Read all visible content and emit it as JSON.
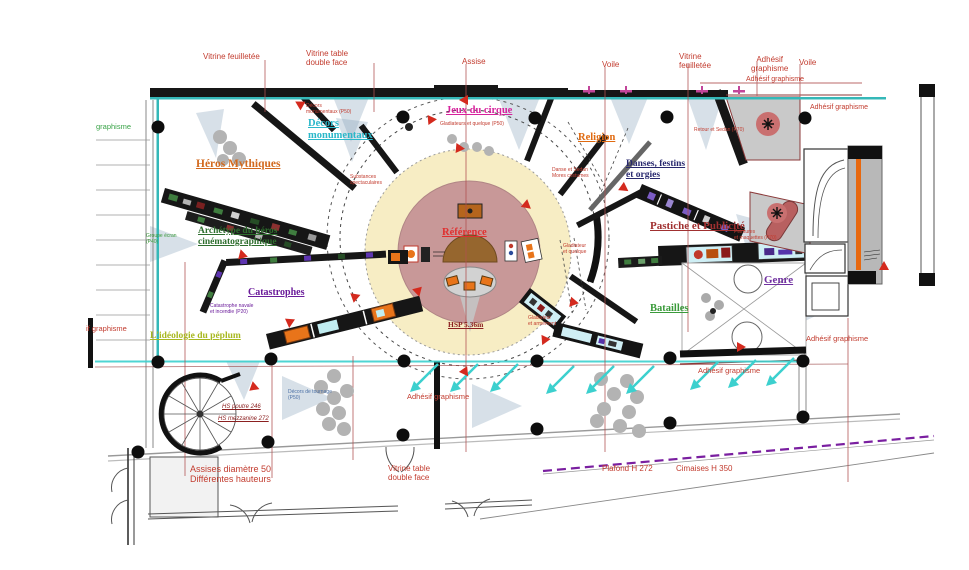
{
  "canvas": {
    "width": 969,
    "height": 570
  },
  "document_type": "exhibition-floor-plan",
  "colors": {
    "wall_black": "#161616",
    "teal_line": "#35b8b8",
    "callout_red": "#c23b2e",
    "dim_line_red": "#b05050",
    "cream_circle": "#f7edc4",
    "mauve_circle": "#c89898",
    "dome_brown": "#96662e",
    "vitrine_orange": "#e8741a",
    "display_cyan": "#cfeff5",
    "room_gray": "#c9c9c9",
    "rose_circle": "#c97070",
    "capsule_rose": "#b86060",
    "arrow_cyan": "#3cd0ce",
    "purple_dashed": "#7a1fa0",
    "stool_gray": "#b3b3b3"
  },
  "labels": [
    {
      "id": "vitrine-feuilletee-top",
      "text": "Vitrine feuilletée",
      "x": 203,
      "y": 52,
      "size": 8,
      "color": "#c23b2e"
    },
    {
      "id": "vitrine-table-top",
      "text": "Vitrine table\ndouble face",
      "x": 306,
      "y": 49,
      "size": 8,
      "color": "#c23b2e"
    },
    {
      "id": "assise-top",
      "text": "Assise",
      "x": 462,
      "y": 57,
      "size": 8,
      "color": "#c23b2e"
    },
    {
      "id": "voile-top-1",
      "text": "Voile",
      "x": 602,
      "y": 60,
      "size": 8,
      "color": "#c23b2e"
    },
    {
      "id": "vitrine-feuilletee-top-2",
      "text": "Vitrine\nfeuilletée",
      "x": 679,
      "y": 52,
      "size": 8,
      "color": "#c23b2e"
    },
    {
      "id": "adhesif-graphisme-top",
      "text": "Adhésif\ngraphisme",
      "x": 751,
      "y": 55,
      "size": 8,
      "color": "#c23b2e",
      "align": "center"
    },
    {
      "id": "voile-top-2",
      "text": "Voile",
      "x": 799,
      "y": 58,
      "size": 8,
      "color": "#c23b2e"
    },
    {
      "id": "adhesif-graphisme-line",
      "text": "Adhésif graphisme",
      "x": 746,
      "y": 76,
      "size": 7,
      "color": "#c23b2e"
    },
    {
      "id": "adhesif-graphisme-right-top",
      "text": "Adhésif graphisme",
      "x": 810,
      "y": 104,
      "size": 7,
      "color": "#c23b2e"
    },
    {
      "id": "graphisme-left",
      "text": "graphisme",
      "x": 96,
      "y": 123,
      "size": 7.5,
      "color": "#3aa348"
    },
    {
      "id": "if-graphisme-left",
      "text": "if graphisme",
      "x": 86,
      "y": 325,
      "size": 7.5,
      "color": "#c23b2e"
    },
    {
      "id": "heros-mythiques",
      "text": "Héros Mythiques",
      "x": 196,
      "y": 158,
      "size": 11.5,
      "color": "#d2691e",
      "bold": true,
      "underline": true,
      "serif": true
    },
    {
      "id": "decors-monumentaux",
      "text": "Décors\nmonumentaux",
      "x": 308,
      "y": 118,
      "size": 10.5,
      "color": "#2ab7c9",
      "bold": true,
      "underline": true,
      "serif": true
    },
    {
      "id": "jeux-du-cirque",
      "text": "Jeux du cirque",
      "x": 446,
      "y": 105,
      "size": 10.5,
      "color": "#d6219c",
      "bold": true,
      "underline": true,
      "serif": true
    },
    {
      "id": "religion",
      "text": "Religion",
      "x": 578,
      "y": 132,
      "size": 10.5,
      "color": "#e06a10",
      "bold": true,
      "underline": true,
      "serif": true
    },
    {
      "id": "danses-festins-et-orgies",
      "text": "Danses, festins\net orgies",
      "x": 626,
      "y": 159,
      "size": 9.5,
      "color": "#28286e",
      "bold": true,
      "underline": true,
      "serif": true
    },
    {
      "id": "pastiche-et-publicite",
      "text": "Pastiche et Publicité",
      "x": 650,
      "y": 220,
      "size": 11,
      "color": "#a03030",
      "bold": true,
      "underline": true,
      "serif": true
    },
    {
      "id": "genre",
      "text": "Genre",
      "x": 764,
      "y": 274,
      "size": 11,
      "color": "#7030a0",
      "bold": true,
      "underline": true,
      "serif": true
    },
    {
      "id": "batailles",
      "text": "Batailles",
      "x": 650,
      "y": 303,
      "size": 10.5,
      "color": "#3a9a3a",
      "bold": true,
      "underline": true,
      "serif": true
    },
    {
      "id": "archetype-du-heros",
      "text": "Archétype du héros\ncinématographique",
      "x": 198,
      "y": 226,
      "size": 9.5,
      "color": "#2e6e2e",
      "bold": true,
      "underline": true,
      "serif": true
    },
    {
      "id": "catastrophes",
      "text": "Catastrophes",
      "x": 248,
      "y": 287,
      "size": 10,
      "color": "#6a1b9a",
      "bold": true,
      "underline": true,
      "serif": true
    },
    {
      "id": "ideologie-du-peplum",
      "text": "L'idéologie du péplum",
      "x": 150,
      "y": 331,
      "size": 9.5,
      "color": "#a8b820",
      "bold": true,
      "underline": true,
      "serif": true
    },
    {
      "id": "reference",
      "text": "Référence",
      "x": 442,
      "y": 227,
      "size": 10.5,
      "color": "#e03030",
      "bold": true,
      "underline": true,
      "serif": true
    },
    {
      "id": "adhesif-graphisme-bottom-center",
      "text": "Adhésif graphisme",
      "x": 407,
      "y": 393,
      "size": 7.5,
      "color": "#c23b2e"
    },
    {
      "id": "adhesif-graphisme-bottom-right",
      "text": "Adhésif graphisme",
      "x": 698,
      "y": 367,
      "size": 7.5,
      "color": "#c23b2e"
    },
    {
      "id": "adhesif-graphisme-right-mid",
      "text": "Adhésif graphisme",
      "x": 806,
      "y": 335,
      "size": 7.5,
      "color": "#c23b2e"
    },
    {
      "id": "assises-diametre",
      "text": "Assises diamètre 50\nDifférentes hauteurs",
      "x": 190,
      "y": 464,
      "size": 9,
      "color": "#c23b2e"
    },
    {
      "id": "vitrine-table-bottom",
      "text": "Vitrine table\ndouble face",
      "x": 388,
      "y": 464,
      "size": 8,
      "color": "#c23b2e"
    },
    {
      "id": "plafond-h272",
      "text": "Plafond H 272",
      "x": 602,
      "y": 464,
      "size": 8,
      "color": "#c23b2e"
    },
    {
      "id": "cimaises-h350",
      "text": "Cimaises  H 350",
      "x": 676,
      "y": 464,
      "size": 8,
      "color": "#c23b2e"
    },
    {
      "id": "hsp-536",
      "text": "HSP 5.36m",
      "x": 448,
      "y": 321,
      "size": 7.5,
      "color": "#8b2020",
      "bold": true,
      "underline": true,
      "serif": true
    },
    {
      "id": "hs-poutre",
      "text": "HS poutre 246",
      "x": 222,
      "y": 404,
      "size": 6,
      "color": "#8b2020",
      "italic": true,
      "underline": true
    },
    {
      "id": "hs-mezzanine",
      "text": "HS mezzanine 272",
      "x": 218,
      "y": 416,
      "size": 6,
      "color": "#8b2020",
      "italic": true,
      "underline": true
    },
    {
      "id": "tiny-substances",
      "text": "Substances\nspectaculaires",
      "x": 350,
      "y": 175,
      "size": 5,
      "color": "#c23b2e"
    },
    {
      "id": "tiny-gladiateurs-jeux",
      "text": "Gladiateurs et quelque (P50)",
      "x": 440,
      "y": 122,
      "size": 5,
      "color": "#c23b2e"
    },
    {
      "id": "tiny-danse-sedan",
      "text": "Danse et Sedan\nMores costumes",
      "x": 552,
      "y": 168,
      "size": 5,
      "color": "#c23b2e"
    },
    {
      "id": "tiny-retour-sedan",
      "text": "Retour et Sedan (P70)",
      "x": 694,
      "y": 128,
      "size": 5,
      "color": "#c23b2e"
    },
    {
      "id": "tiny-gladiateur-quelque",
      "text": "Gladiateur\net quelque",
      "x": 563,
      "y": 244,
      "size": 5,
      "color": "#c23b2e"
    },
    {
      "id": "tiny-gladiateur-armement",
      "text": "Gladiateur\net armement",
      "x": 528,
      "y": 316,
      "size": 5,
      "color": "#c23b2e"
    },
    {
      "id": "tiny-catastrophe-navale",
      "text": "Catastrophe navale\net incendie (P20)",
      "x": 210,
      "y": 304,
      "size": 5,
      "color": "#6a1b9a"
    },
    {
      "id": "tiny-groupe-ecran",
      "text": "Groupe écran\n(P40)",
      "x": 146,
      "y": 234,
      "size": 5,
      "color": "#3a9a3a"
    },
    {
      "id": "tiny-decors-tournage",
      "text": "Décors de tournage\n(P50)",
      "x": 288,
      "y": 390,
      "size": 5,
      "color": "#4a6fa5"
    },
    {
      "id": "tiny-peintures-maquettes",
      "text": "Peintures\net maquettes (P70)",
      "x": 734,
      "y": 230,
      "size": 5,
      "color": "#c23b2e"
    },
    {
      "id": "tiny-decors-monumentaux",
      "text": "Décors\nmonumentaux (P50)",
      "x": 306,
      "y": 104,
      "size": 5,
      "color": "#c23b2e"
    }
  ]
}
